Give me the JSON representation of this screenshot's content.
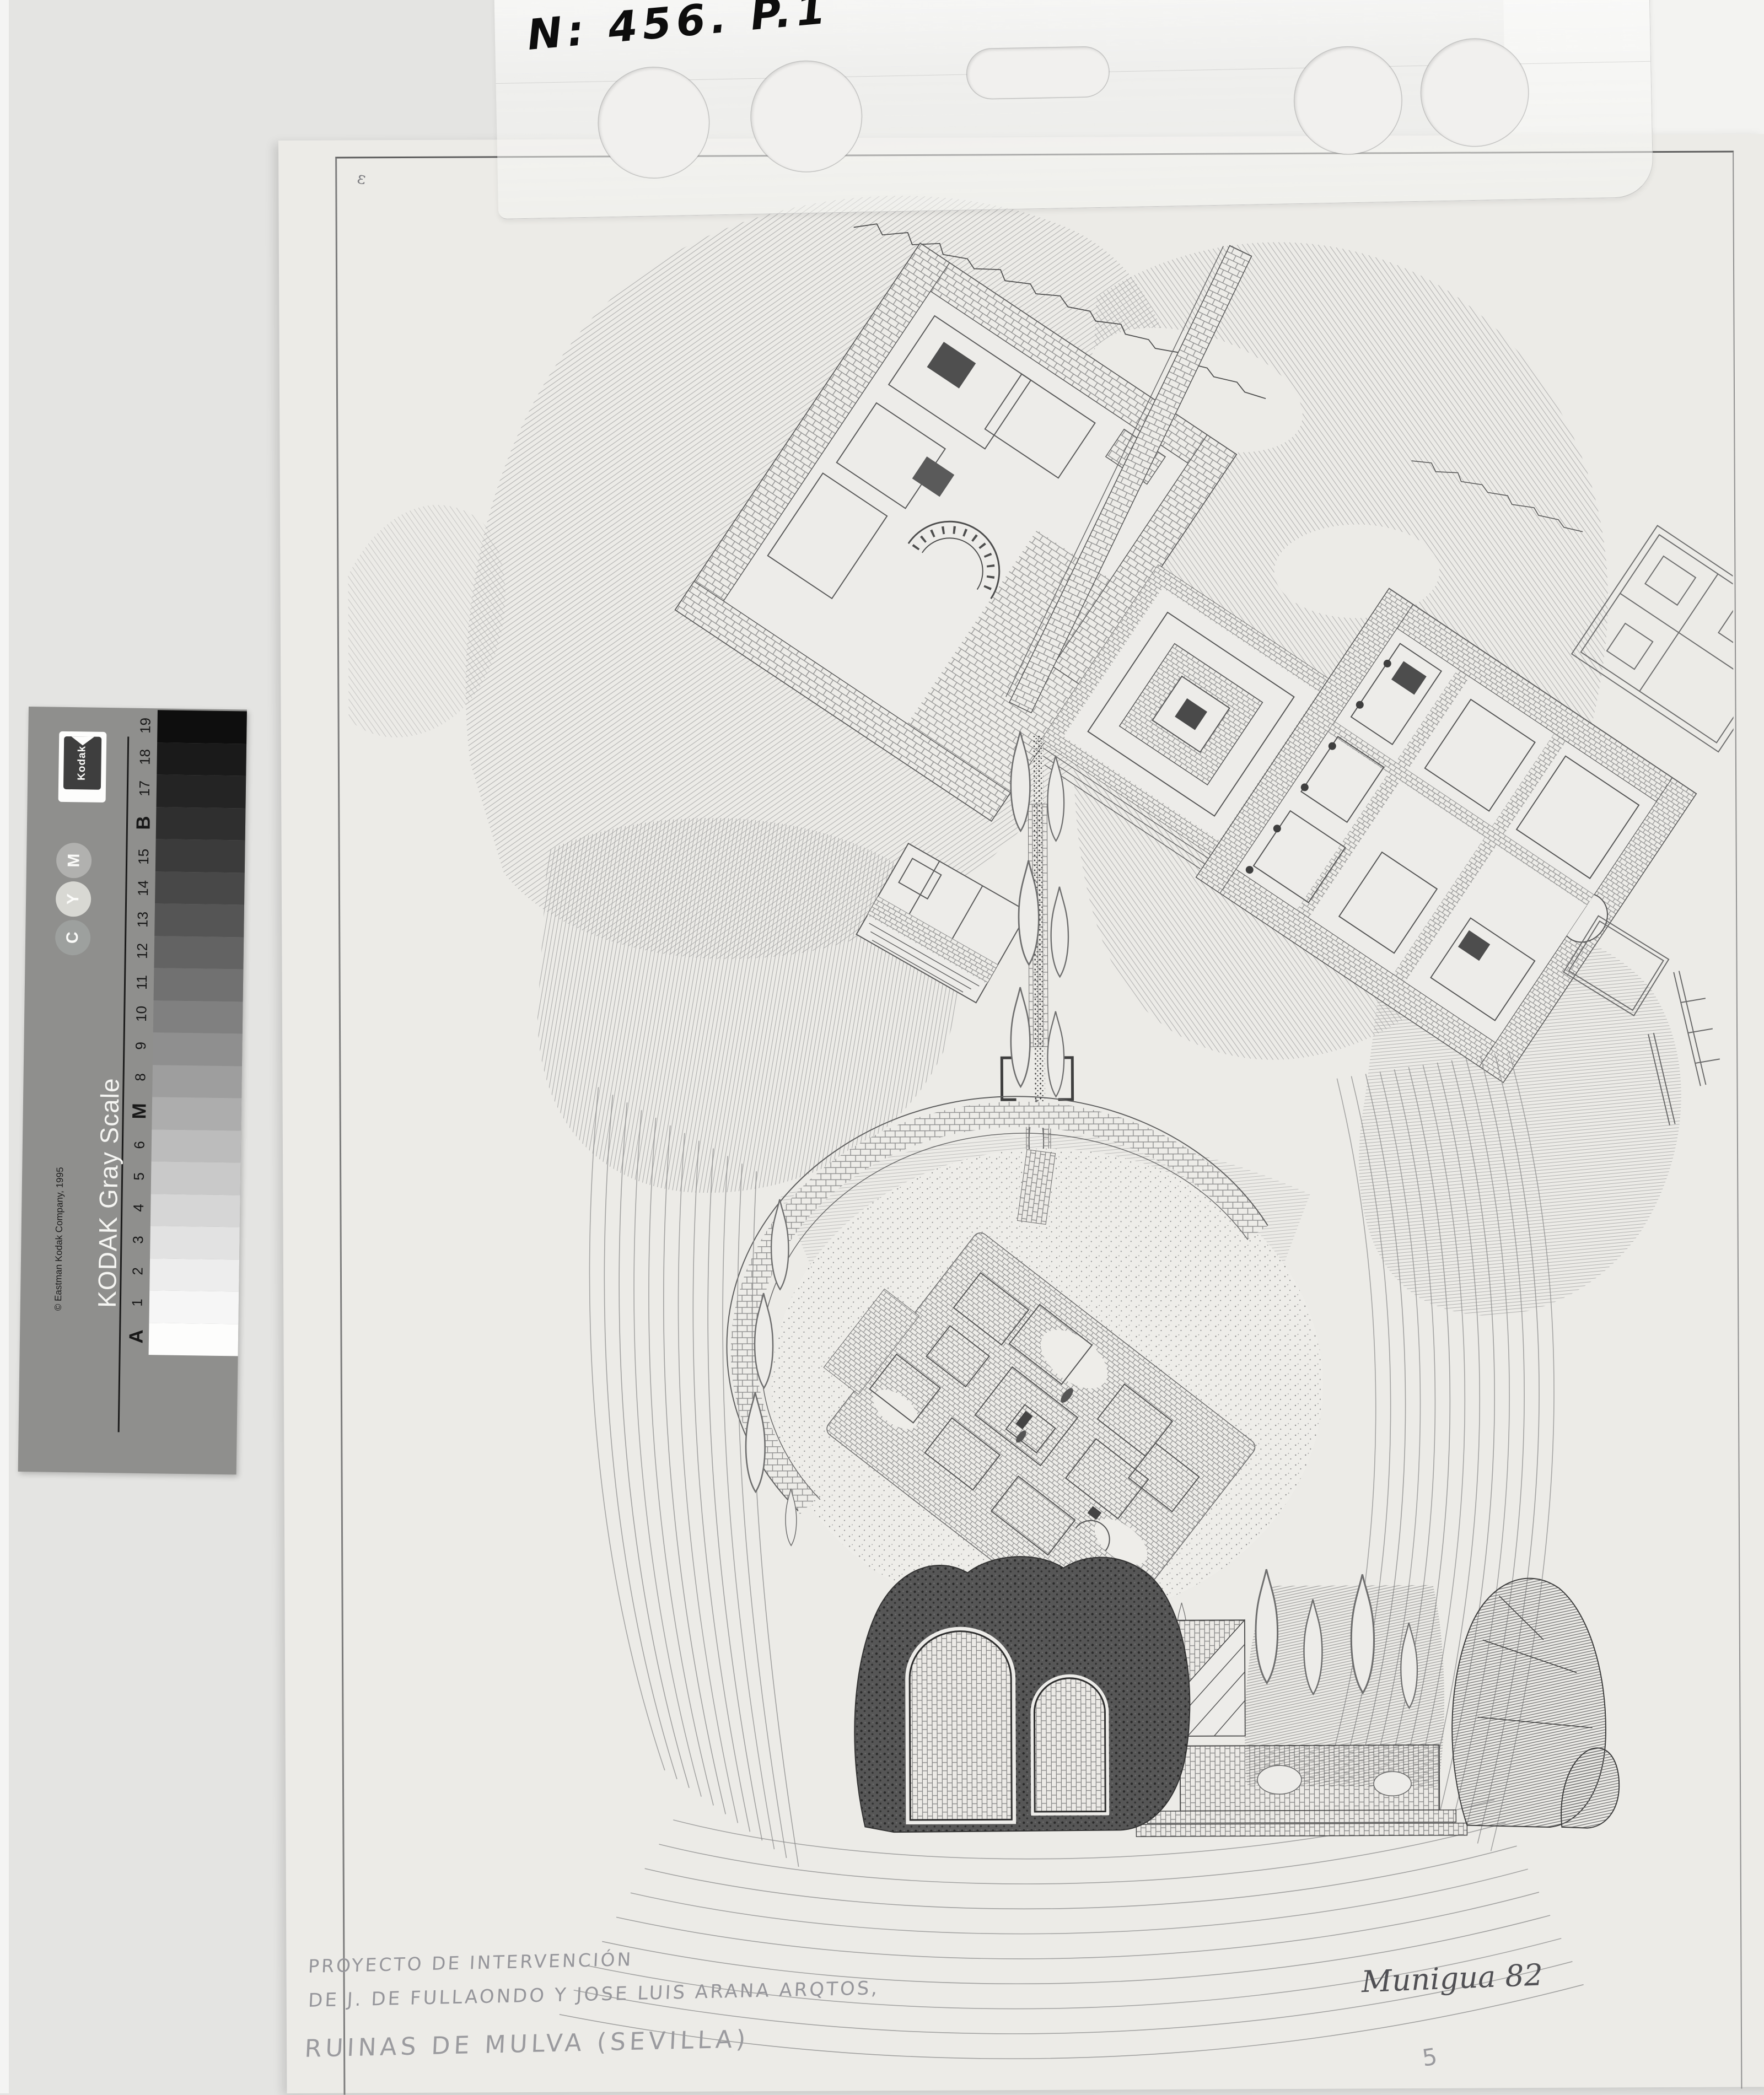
{
  "photo": {
    "background_color": "#e4e4e2",
    "sheet_color": "#ecebe7"
  },
  "label_strip": {
    "code": "N: 456. P.1"
  },
  "gray_scale_card": {
    "brand": "Kodak",
    "title": "KODAK Gray Scale",
    "copyright": "© Eastman Kodak Company, 1995",
    "ink_dots": [
      {
        "letter": "M",
        "color": "#b1b1af"
      },
      {
        "letter": "Y",
        "color": "#d8d8d3"
      },
      {
        "letter": "C",
        "color": "#9da09e"
      }
    ],
    "patches": [
      {
        "label": "19",
        "color": "#0e0e0e"
      },
      {
        "label": "18",
        "color": "#1a1a1a"
      },
      {
        "label": "17",
        "color": "#242424"
      },
      {
        "label": "B",
        "color": "#2f2f2f"
      },
      {
        "label": "15",
        "color": "#3b3b3b"
      },
      {
        "label": "14",
        "color": "#484848"
      },
      {
        "label": "13",
        "color": "#555555"
      },
      {
        "label": "12",
        "color": "#636363"
      },
      {
        "label": "11",
        "color": "#717171"
      },
      {
        "label": "10",
        "color": "#808080"
      },
      {
        "label": "9",
        "color": "#8f8f8f"
      },
      {
        "label": "8",
        "color": "#9e9e9e"
      },
      {
        "label": "M",
        "color": "#adadad"
      },
      {
        "label": "6",
        "color": "#bcbcbc"
      },
      {
        "label": "5",
        "color": "#c9c9c9"
      },
      {
        "label": "4",
        "color": "#d6d6d6"
      },
      {
        "label": "3",
        "color": "#e2e2e2"
      },
      {
        "label": "2",
        "color": "#ededed"
      },
      {
        "label": "1",
        "color": "#f6f6f6"
      },
      {
        "label": "A",
        "color": "#fdfdfc"
      }
    ]
  },
  "drawing": {
    "caption_lines": [
      "PROYECTO DE INTERVENCIÓN",
      "DE J. DE FULLAONDO Y JOSE LUIS ARANA ARQTOS,",
      "RUINAS DE MULVA (SEVILLA)"
    ],
    "inscription": "Munigua 82",
    "sheet_number": "5",
    "corner_mark": "ε"
  }
}
